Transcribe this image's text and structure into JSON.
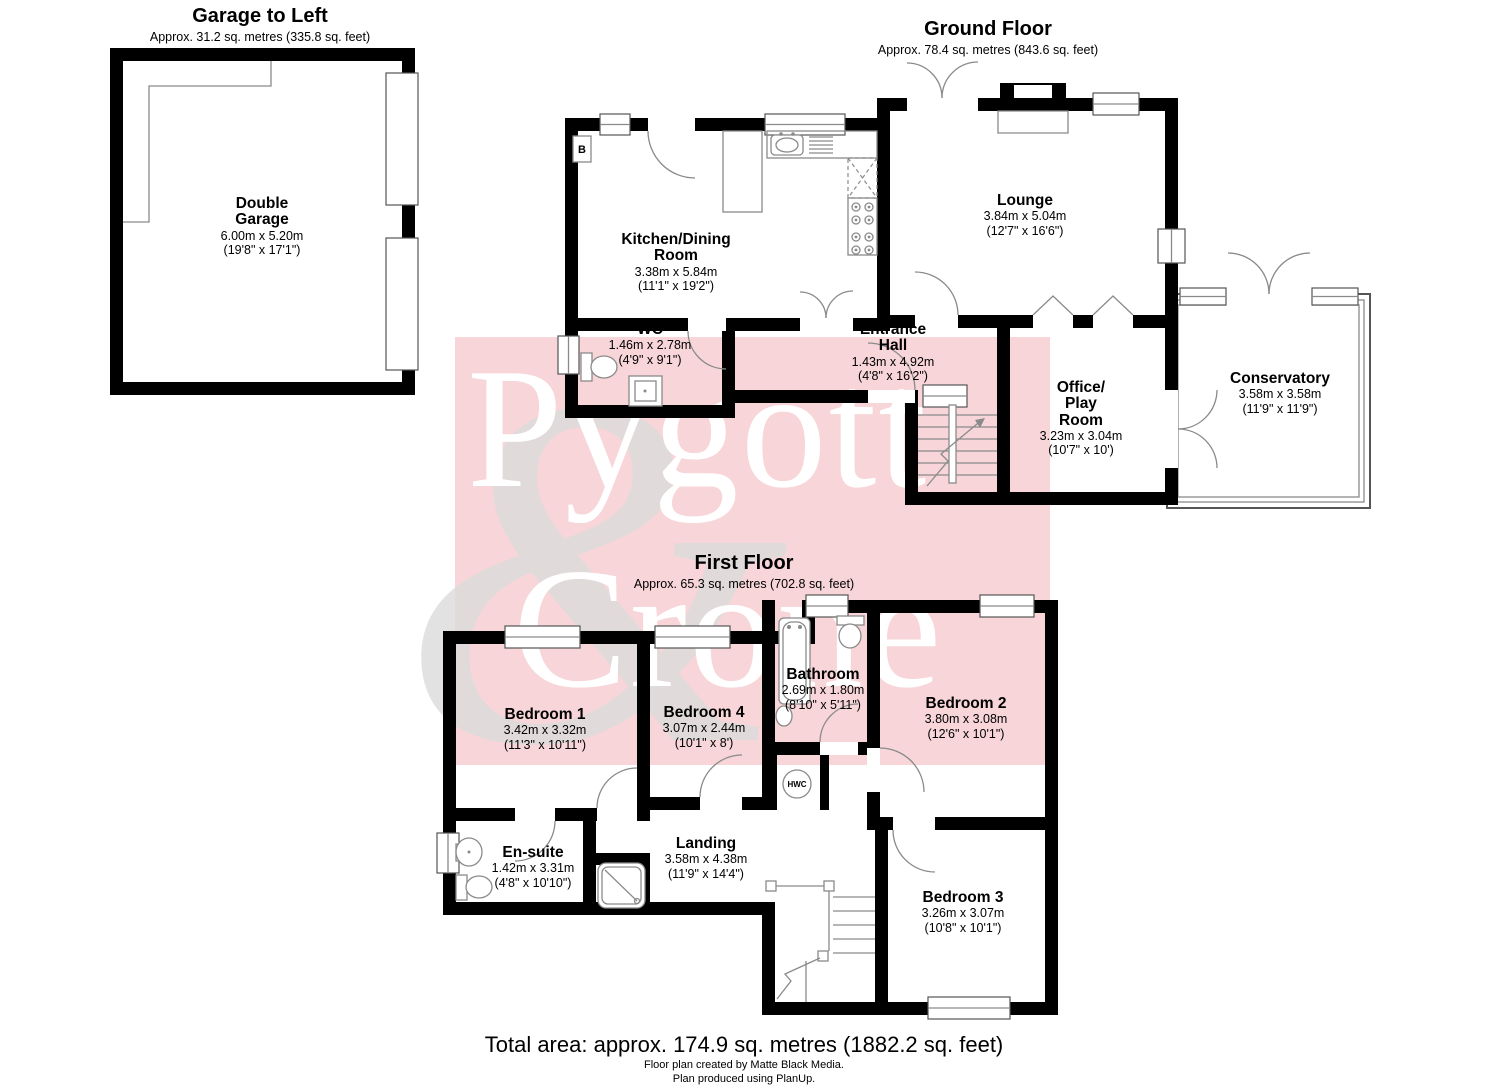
{
  "watermark": {
    "word1": "Pygott",
    "word2": "Crone",
    "ampersand": "&",
    "band_color": "#f7d5d8",
    "word_color": "#ffffff"
  },
  "headers": {
    "garage": {
      "title": "Garage to Left",
      "approx": "Approx. 31.2 sq. metres (335.8 sq. feet)"
    },
    "ground": {
      "title": "Ground Floor",
      "approx": "Approx. 78.4 sq. metres (843.6 sq. feet)"
    },
    "first": {
      "title": "First Floor",
      "approx": "Approx. 65.3 sq. metres (702.8 sq. feet)"
    }
  },
  "rooms": {
    "garage": {
      "name": "Double\nGarage",
      "metric": "6.00m x 5.20m",
      "imperial": "(19'8\" x 17'1\")"
    },
    "kitchen": {
      "name": "Kitchen/Dining\nRoom",
      "metric": "3.38m x 5.84m",
      "imperial": "(11'1\" x 19'2\")"
    },
    "wc": {
      "name": "WC",
      "metric": "1.46m x 2.78m",
      "imperial": "(4'9\" x 9'1\")"
    },
    "hall": {
      "name": "Entrance\nHall",
      "metric": "1.43m x 4.92m",
      "imperial": "(4'8\" x 16'2\")"
    },
    "lounge": {
      "name": "Lounge",
      "metric": "3.84m x 5.04m",
      "imperial": "(12'7\" x 16'6\")"
    },
    "office": {
      "name": "Office/\nPlay\nRoom",
      "metric": "3.23m x 3.04m",
      "imperial": "(10'7\" x 10')"
    },
    "conservatory": {
      "name": "Conservatory",
      "metric": "3.58m x 3.58m",
      "imperial": "(11'9\" x 11'9\")"
    },
    "bedroom1": {
      "name": "Bedroom 1",
      "metric": "3.42m x 3.32m",
      "imperial": "(11'3\" x 10'11\")"
    },
    "bedroom4": {
      "name": "Bedroom 4",
      "metric": "3.07m x 2.44m",
      "imperial": "(10'1\" x 8')"
    },
    "bathroom": {
      "name": "Bathroom",
      "metric": "2.69m x 1.80m",
      "imperial": "(8'10\" x 5'11\")"
    },
    "bedroom2": {
      "name": "Bedroom 2",
      "metric": "3.80m x 3.08m",
      "imperial": "(12'6\" x 10'1\")"
    },
    "ensuite": {
      "name": "En-suite",
      "metric": "1.42m x 3.31m",
      "imperial": "(4'8\" x 10'10\")"
    },
    "landing": {
      "name": "Landing",
      "metric": "3.58m x 4.38m",
      "imperial": "(11'9\" x 14'4\")"
    },
    "bedroom3": {
      "name": "Bedroom 3",
      "metric": "3.26m x 3.07m",
      "imperial": "(10'8\" x 10'1\")"
    }
  },
  "markers": {
    "boiler": "B",
    "hot_water": "HWC"
  },
  "footer": {
    "total": "Total area: approx. 174.9 sq. metres (1882.2 sq. feet)",
    "credit1": "Floor plan created by Matte Black Media.",
    "credit2": "Plan produced using PlanUp."
  },
  "colors": {
    "wall": "#000000",
    "fixture_line": "#8a8a8a",
    "text": "#000000"
  }
}
